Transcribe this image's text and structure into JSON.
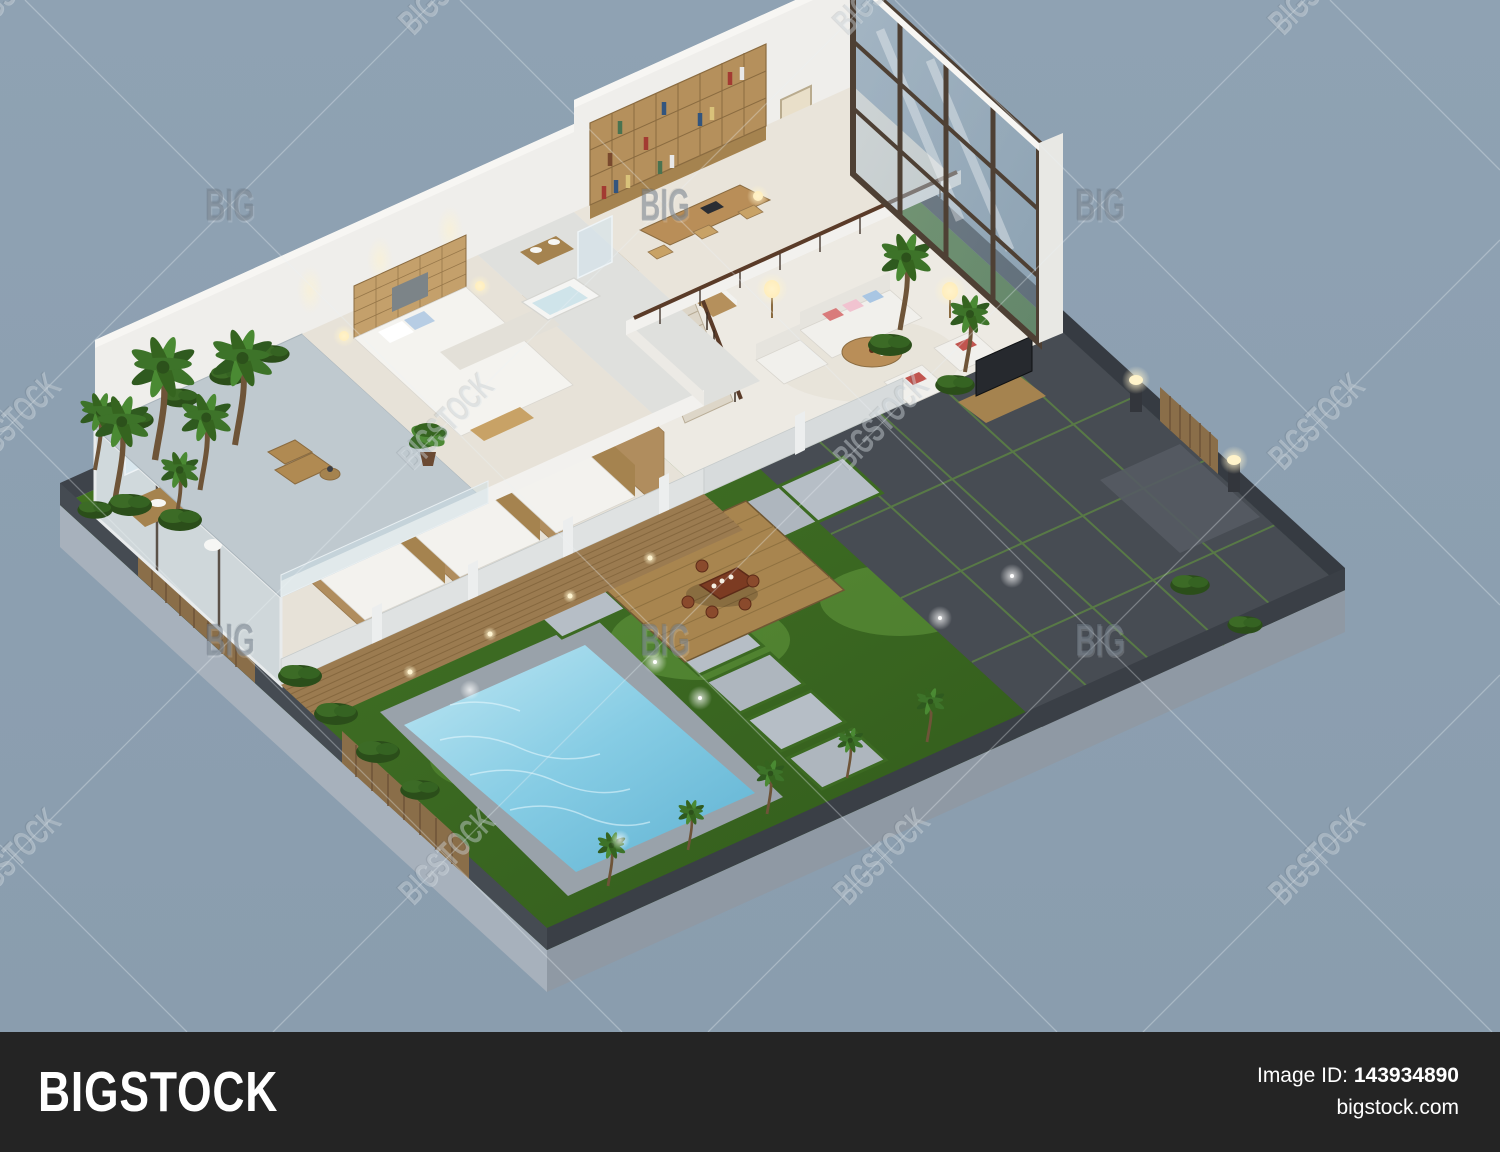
{
  "page": {
    "width": 1500,
    "height": 1152,
    "background_color": "#8c9fb1"
  },
  "watermark": {
    "big_label": "BIG",
    "bigstock_label": "BIGSTOCK"
  },
  "footer": {
    "logo_text": "BIGSTOCK",
    "image_id_label": "Image ID:",
    "image_id_value": "143934890",
    "website_text": "bigstock.com",
    "bar_color": "#242424",
    "text_color": "#ffffff"
  },
  "scene": {
    "type": "isometric-villa-cutaway-render",
    "description": "3D isometric cutaway rendering of a two-story modern villa: furnished bedrooms, bathrooms, living room, dining and kitchen on the ground floor; master suite, library and roof terrace above; double-height glass curtain wall with interior palm atrium; walled garden with lawn, square swimming pool, wooden tea deck, stone paver paths, palm trees, gated driveway and garden lights on a grey-blue backdrop",
    "colors": {
      "lawn": "#3c6a22",
      "pool_water": "#74c2de",
      "wood": "#b08d5e",
      "walls": "#efeeeb",
      "base_plinth": "#a7b1bc",
      "perimeter_wall": "#3e434a",
      "pavement": "#474c53",
      "glass": "#9fb4c4",
      "tea_deck": "#a8854f",
      "warm_light": "#ffe9b0"
    },
    "rooms": [
      "bathroom",
      "bedroom-1",
      "bedroom-2",
      "bedroom-3",
      "living-room",
      "dining-room",
      "kitchen",
      "staircase",
      "master-bedroom",
      "master-bathroom",
      "library-study",
      "roof-terrace",
      "glass-atrium"
    ],
    "outdoor_features": [
      "lawn",
      "swimming-pool",
      "tea-deck",
      "stone-paths",
      "palm-cluster",
      "shrubs",
      "wooden-fences",
      "driveway",
      "gate",
      "pillar-lamps",
      "garden-lights"
    ]
  }
}
